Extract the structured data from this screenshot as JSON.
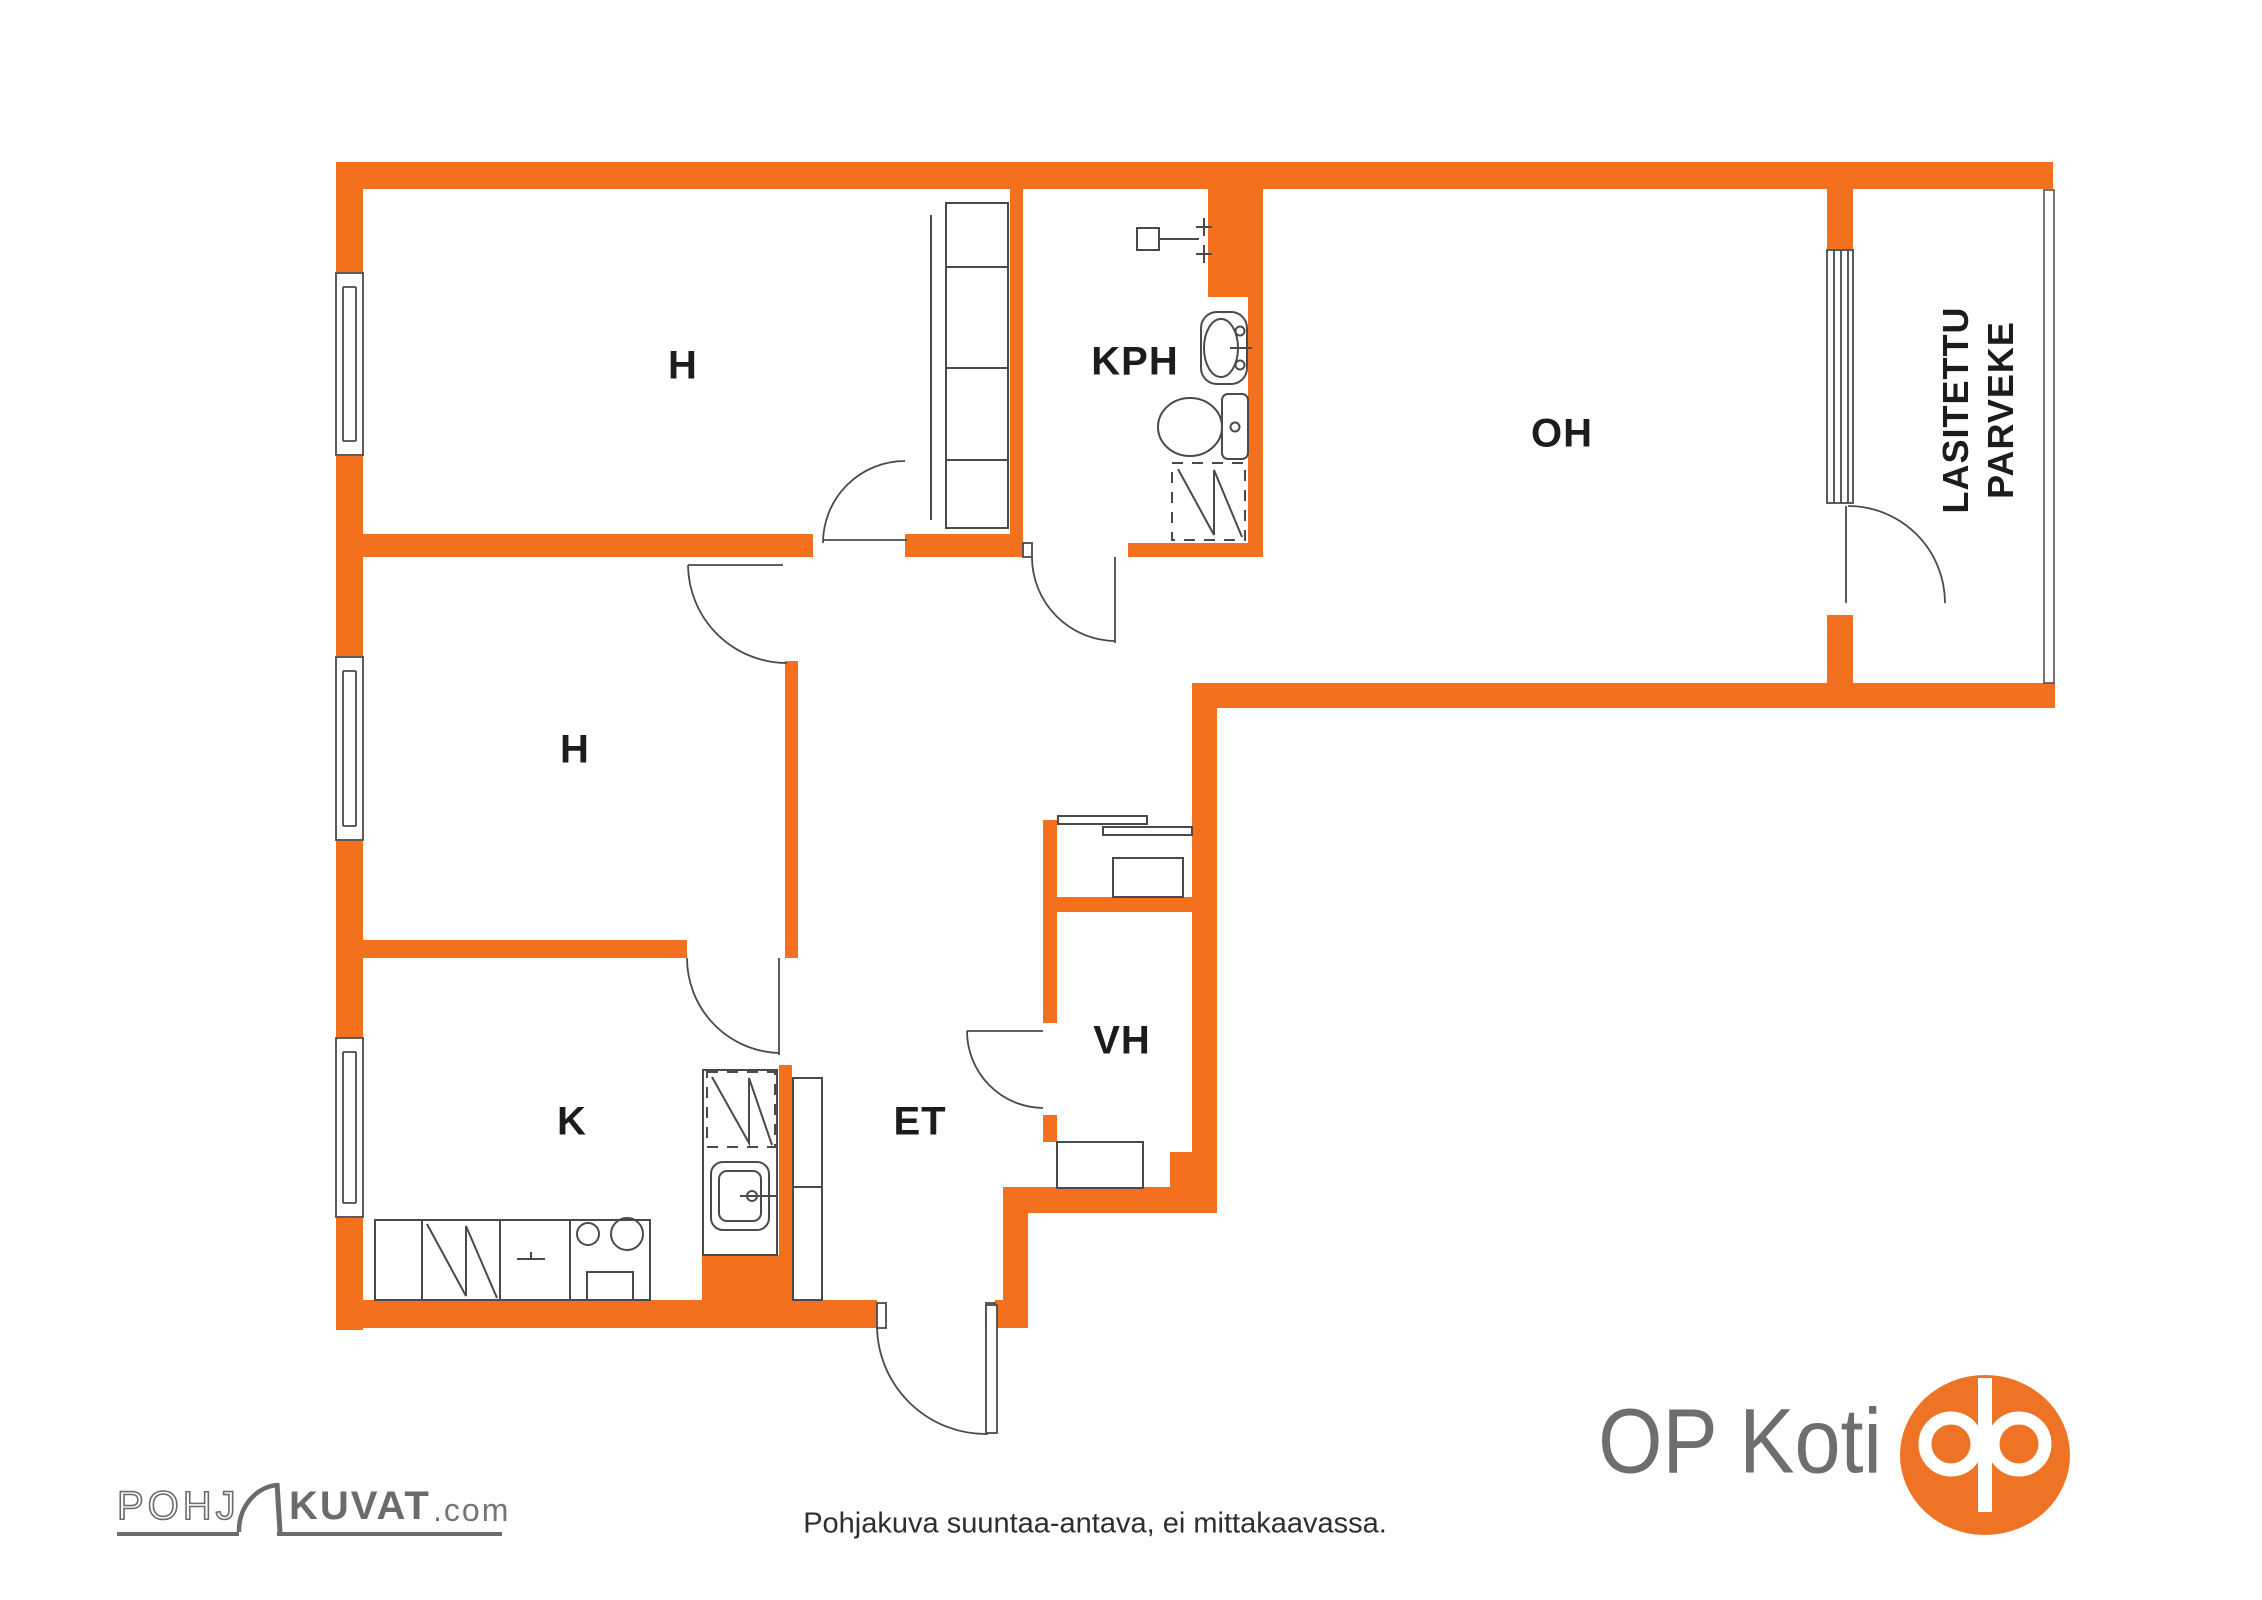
{
  "floorplan": {
    "colors": {
      "wall_orange": "#F2701E",
      "fixture_line": "#4a4a4a",
      "label_text": "#1c1c1c"
    },
    "room_labels": {
      "bedroom1": "H",
      "bedroom2": "H",
      "kitchen": "K",
      "entry": "ET",
      "closet": "VH",
      "bathroom": "KPH",
      "living_room": "OH"
    },
    "balcony_label": {
      "line1": "LASITETTU",
      "line2": "PARVEKE"
    }
  },
  "footer": {
    "disclaimer": "Pohjakuva suuntaa-antava, ei mittakaavassa.",
    "pohjakuvat_logo": {
      "outline_part": "POHJ",
      "bold_part": "KUVAT",
      "domain_suffix": ".com"
    },
    "op_logo": {
      "wordmark": "OP Koti",
      "brand_orange": "#EE7324"
    }
  }
}
